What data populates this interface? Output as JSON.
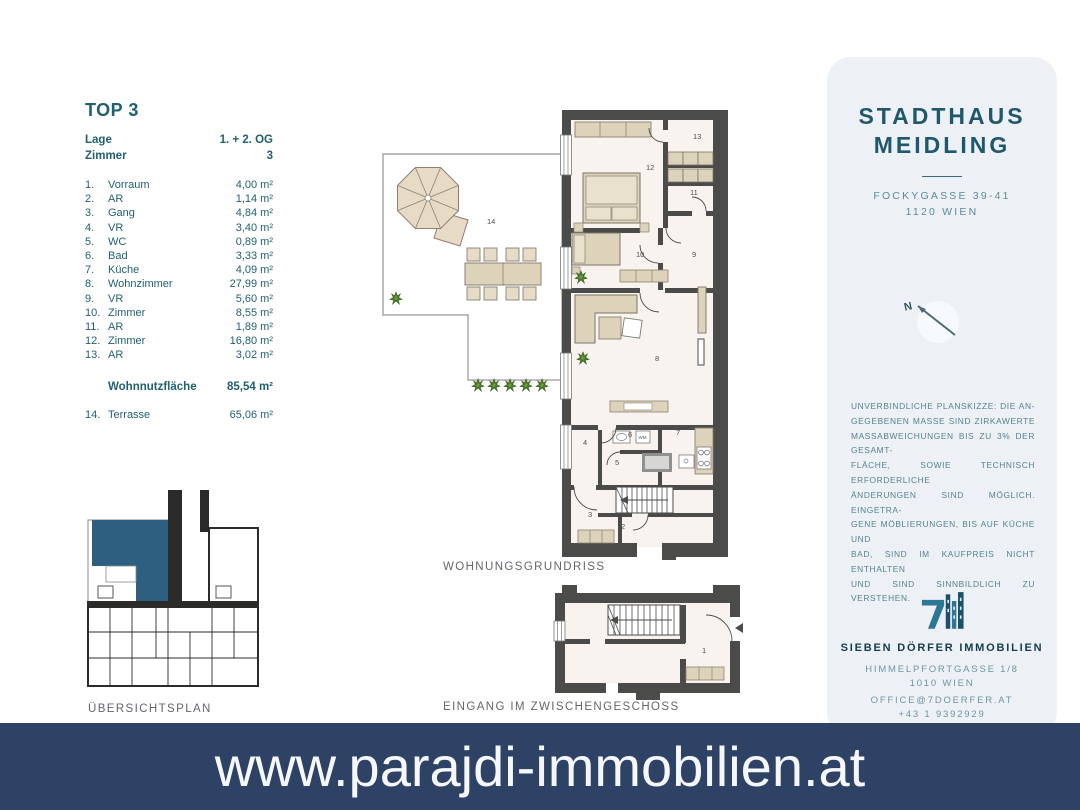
{
  "unit": {
    "title": "TOP 3",
    "location_label": "Lage",
    "location_value": "1. + 2. OG",
    "rooms_count_label": "Zimmer",
    "rooms_count_value": "3",
    "rooms": [
      {
        "nr": "1.",
        "name": "Vorraum",
        "area": "4,00 m²"
      },
      {
        "nr": "2.",
        "name": "AR",
        "area": "1,14 m²"
      },
      {
        "nr": "3.",
        "name": "Gang",
        "area": "4,84 m²"
      },
      {
        "nr": "4.",
        "name": "VR",
        "area": "3,40 m²"
      },
      {
        "nr": "5.",
        "name": "WC",
        "area": "0,89 m²"
      },
      {
        "nr": "6.",
        "name": "Bad",
        "area": "3,33 m²"
      },
      {
        "nr": "7.",
        "name": "Küche",
        "area": "4,09 m²"
      },
      {
        "nr": "8.",
        "name": "Wohnzimmer",
        "area": "27,99 m²"
      },
      {
        "nr": "9.",
        "name": "VR",
        "area": "5,60 m²"
      },
      {
        "nr": "10.",
        "name": "Zimmer",
        "area": "8,55 m²"
      },
      {
        "nr": "11.",
        "name": "AR",
        "area": "1,89 m²"
      },
      {
        "nr": "12.",
        "name": "Zimmer",
        "area": "16,80 m²"
      },
      {
        "nr": "13.",
        "name": "AR",
        "area": "3,02 m²"
      }
    ],
    "total_label": "Wohnnutzfläche",
    "total_value": "85,54 m²",
    "terrace_nr": "14.",
    "terrace_name": "Terrasse",
    "terrace_value": "65,06 m²"
  },
  "plan": {
    "caption_main": "WOHNUNGSGRUNDRISS",
    "caption_entrance": "EINGANG IM ZWISCHENGESCHOSS",
    "caption_overview": "ÜBERSICHTSPLAN",
    "room_numbers": [
      "1",
      "2",
      "3",
      "4",
      "5",
      "6",
      "7",
      "8",
      "9",
      "10",
      "11",
      "12",
      "13",
      "14"
    ],
    "wm_label": "WM"
  },
  "project": {
    "name_line1": "STADTHAUS",
    "name_line2": "MEIDLING",
    "address_line1": "FOCKYGASSE 39-41",
    "address_line2": "1120 WIEN",
    "compass_label": "N",
    "disclaimer_lines": [
      "UNVERBINDLICHE PLANSKIZZE: DIE AN-",
      "GEGEBENEN MASSE SIND ZIRKAWERTE",
      "MASSABWEICHUNGEN BIS ZU 3% DER GESAMT-",
      "FLÄCHE, SOWIE TECHNISCH ERFORDERLICHE",
      "ÄNDERUNGEN SIND MÖGLICH. EINGETRA-",
      "GENE MÖBLIERUNGEN, BIS AUF KÜCHE UND",
      "BAD, SIND IM KAUFPREIS NICHT ENTHALTEN",
      "UND SIND SINNBILDLICH ZU VERSTEHEN."
    ],
    "broker_name": "SIEBEN DÖRFER IMMOBILIEN",
    "broker_address_line1": "HIMMELPFORTGASSE 1/8",
    "broker_address_line2": "1010 WIEN",
    "broker_email": "OFFICE@7DOERFER.AT",
    "broker_phone": "+43 1 9392929"
  },
  "footer": {
    "website": "www.parajdi-immobilien.at"
  },
  "colors": {
    "banner_navy": "#2e4266",
    "panel_bg": "#edf1f5",
    "accent_teal": "#21606f",
    "highlight_blue": "#2d6080",
    "wall_gray": "#4b4b49",
    "furniture_beige": "#ddd2ba"
  }
}
